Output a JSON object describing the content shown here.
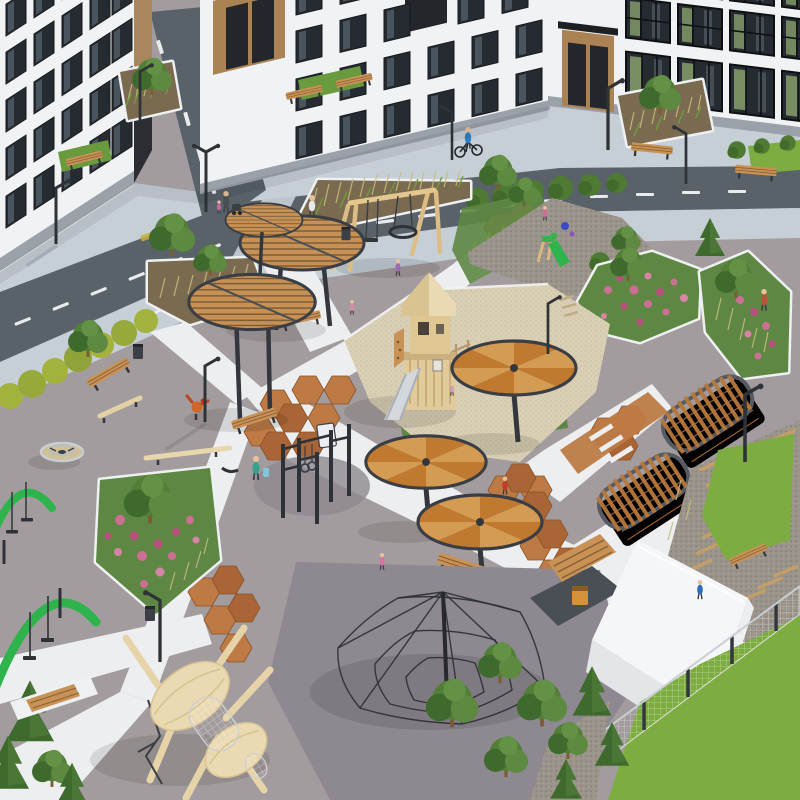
{
  "scene": {
    "type": "3d-architectural-render",
    "subject": "residential-courtyard-playground",
    "view": "aerial-isometric"
  },
  "palette": {
    "building_white": "#f1f2f4",
    "building_shade": "#e2e4e8",
    "building_tan": "#ab8254",
    "building_end_tan": "#a8875f",
    "building_plinth": "#9aa1a9",
    "window_glass": "#262b31",
    "window_streak": "#5a6672",
    "window_green": "#87a06b",
    "road": "#596169",
    "road_marking": "#e9ebed",
    "sidewalk": "#c6ced6",
    "plaza": "#a39c9e",
    "plaza_dark": "#8e8890",
    "path": "#eceeef",
    "terracotta": "#bd7a45",
    "terracotta_dark": "#a96536",
    "sand": "#d9cfb5",
    "gravel": "#9a948a",
    "lawn": "#7dac41",
    "lawn_dull": "#699b3e",
    "hedge": "#4e7a33",
    "hedge_yellow": "#a3b23d",
    "tree": "#527e37",
    "tree_dark": "#3e6a2d",
    "flower_pink": "#cd6f94",
    "flower_deep": "#b94f7d",
    "flower_leaf": "#5d8742",
    "soil": "#7a6a50",
    "wood": "#c89257",
    "wood_light": "#e2cb9b",
    "wood_pale": "#e9dab3",
    "pergola_wood": "#b8793d",
    "steel": "#33373d",
    "canopy_wood": "#c79155",
    "canopy_pie_light": "#d49b53",
    "canopy_pie_dark": "#c07a30",
    "swing_green": "#2fb44d",
    "slide_metal": "#d4d8dc",
    "white_building": "#f5f6f8",
    "white_building_side": "#e3e5e9",
    "net_rope": "#2c2f34",
    "dumpster_orange": "#d69238",
    "tactile_yellow": "#c8b23c",
    "skin": "#e9c29c"
  },
  "people_colors": {
    "cyclist": "#2e7fc2",
    "walker_white": "#e8e8ea",
    "walker_teal": "#3aa08a",
    "kid_red": "#c23b2e",
    "kid_pink": "#d773a0",
    "kid_purple": "#9a6cb4",
    "sitting_blue": "#2f6fb5",
    "stander_rust": "#b5563c",
    "stroller_gray": "#4a4e55"
  },
  "objects": {
    "buildings": [
      "apartment-building-left",
      "apartment-building-top",
      "apartment-building-right",
      "white-utility-building",
      "waste-shelter"
    ],
    "circulation": [
      "asphalt-road",
      "road-branch",
      "dashed-centerlines",
      "sidewalks",
      "white-pedestrian-paths",
      "terracotta-hex-paving",
      "gravel-plank-paths",
      "crosswalk",
      "tactile-strips"
    ],
    "play_equipment": [
      "wood-slat-round-canopies",
      "pie-segment-round-canopies",
      "wooden-swing-set",
      "nest-ring-swing",
      "climbing-tower-with-slide",
      "sand-pit",
      "toddler-slide",
      "street-workout-bars",
      "rope-pyramid-net",
      "carousel",
      "balance-beams",
      "green-arc-swings",
      "wooden-insect-sculpture",
      "pergola-tunnels",
      "rooster-spring-rider"
    ],
    "landscape": [
      "pink-flower-beds",
      "ornamental-grass-planters",
      "yellow-hedge",
      "dark-hedges",
      "leafy-trees",
      "conifers",
      "lawns",
      "gravel-toddler-area"
    ],
    "street_furniture": [
      "wood-benches",
      "trash-bins",
      "street-lamps",
      "mesh-fence",
      "orange-dumpster"
    ],
    "people": [
      "cyclist",
      "pedestrian-with-stroller",
      "pedestrians",
      "children-playing",
      "sitting-person"
    ]
  }
}
